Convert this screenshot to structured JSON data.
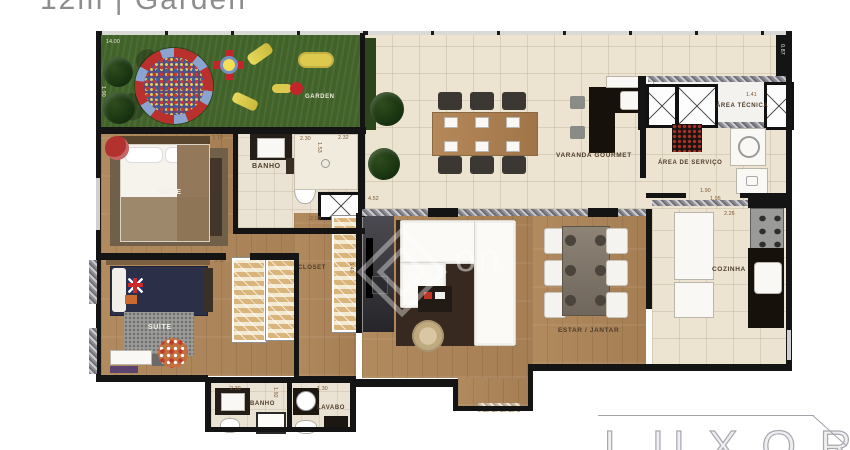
{
  "title": "12m | Garden",
  "colors": {
    "wall": "#141414",
    "grass": "#41632a",
    "wood": "#b18a5e",
    "tile": "#ece3d0",
    "accent_red": "#b23230",
    "navy_bed": "#2b3048",
    "watermark_gray": "#a8a8b0"
  },
  "rooms": {
    "garden": {
      "label": "GARDEN"
    },
    "suite_top": {
      "label": "SUÍTE"
    },
    "banho_top": {
      "label": "BANHO"
    },
    "varanda": {
      "label": "VARANDA GOURMET"
    },
    "area_tecnica": {
      "label": "ÁREA TÉCNICA"
    },
    "area_servico": {
      "label": "ÁREA DE SERVIÇO"
    },
    "cozinha": {
      "label": "COZINHA"
    },
    "estar": {
      "label": "ESTAR / JANTAR"
    },
    "closet": {
      "label": "CLOSET"
    },
    "suite_bottom": {
      "label": "SUÍTE"
    },
    "banho_bottom": {
      "label": "BANHO"
    },
    "lavabo": {
      "label": "LAVABO"
    }
  },
  "measurements": [
    {
      "text": "14.00"
    },
    {
      "text": "1.90"
    },
    {
      "text": "3.10"
    },
    {
      "text": "2.30"
    },
    {
      "text": "1.53"
    },
    {
      "text": "2.32"
    },
    {
      "text": "0.87"
    },
    {
      "text": "1.41"
    },
    {
      "text": "1.90"
    },
    {
      "text": "1.95"
    },
    {
      "text": "2.26"
    },
    {
      "text": "4.52"
    },
    {
      "text": "4.40"
    },
    {
      "text": "2.09"
    },
    {
      "text": "3.40"
    },
    {
      "text": "3.30"
    },
    {
      "text": "2.30"
    },
    {
      "text": "1.92"
    },
    {
      "text": "1.30"
    }
  ],
  "watermarks": {
    "center_text": "on",
    "brand": "LUXOR"
  }
}
